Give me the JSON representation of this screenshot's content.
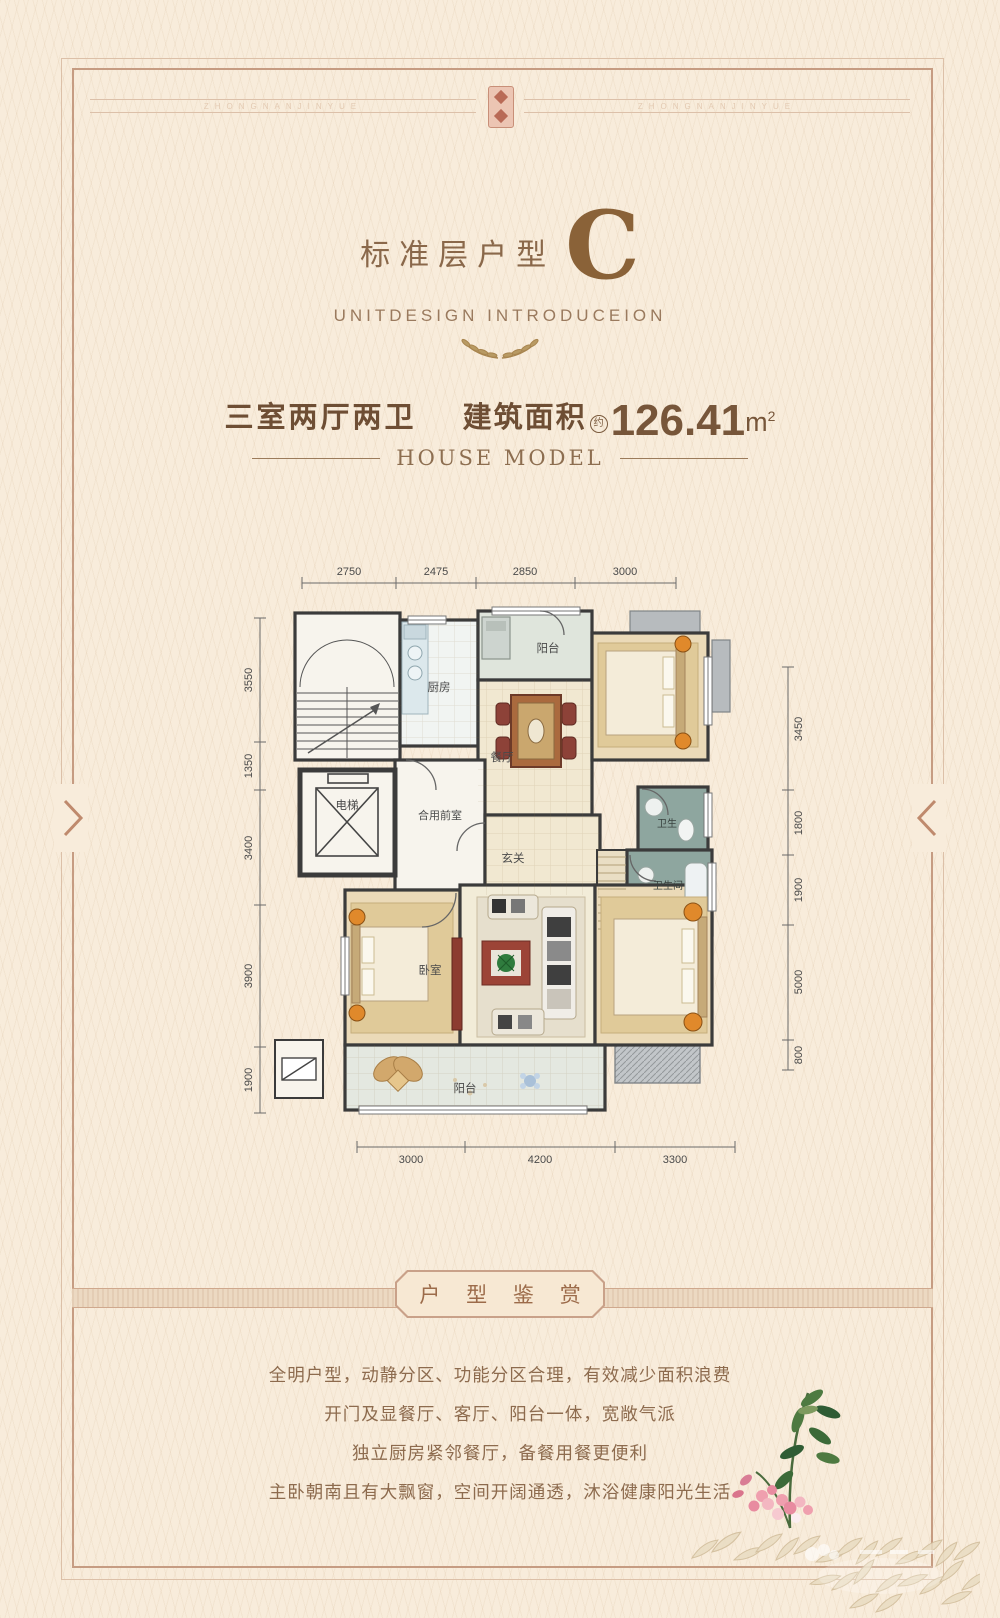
{
  "poster": {
    "band_text_left": "ZHONGNANJINYUE",
    "band_text_right": "ZHONGNANJINYUE"
  },
  "header": {
    "title": "标准层户型",
    "type_letter": "C",
    "subtitle": "UNITDESIGN  INTRODUCEION"
  },
  "specs": {
    "layout": "三室两厅两卫",
    "area_label": "建筑面积",
    "area_approx": "约",
    "area_value": "126.41",
    "area_unit": "m",
    "area_exponent": "2",
    "tagline": "HOUSE MODEL"
  },
  "floorplan": {
    "rooms": {
      "kitchen": "厨房",
      "balcony_top": "阳台",
      "dining": "餐厅",
      "elevator": "电梯",
      "lobby": "合用前室",
      "foyer": "玄关",
      "bath_top": "卫生",
      "bath_bottom": "卫生间",
      "bedroom": "卧室",
      "balcony_bottom": "阳台"
    },
    "dims": {
      "top": [
        "2750",
        "2475",
        "2850",
        "3000"
      ],
      "left": [
        "3550",
        "1350",
        "3400",
        "3900",
        "1900"
      ],
      "right": [
        "3450",
        "1800",
        "1900",
        "5000",
        "800"
      ],
      "bottom": [
        "3000",
        "4200",
        "3300"
      ]
    }
  },
  "banner": {
    "title": "户 型 鉴 赏"
  },
  "description": {
    "line1": "全明户型，动静分区、功能分区合理，有效减少面积浪费",
    "line2": "开门及显餐厅、客厅、阳台一体，宽敞气派",
    "line3": "独立厨房紧邻餐厅，备餐用餐更便利",
    "line4": "主卧朝南且有大飘窗，空间开阔通透，沐浴健康阳光生活"
  },
  "colors": {
    "accent_brown": "#8a6a4c",
    "bronze": "#8a6238",
    "frame": "#c69c82",
    "wall": "#3b3b3b",
    "bath_teal": "#8ea69f",
    "floor_tan": "#ebdab8"
  }
}
